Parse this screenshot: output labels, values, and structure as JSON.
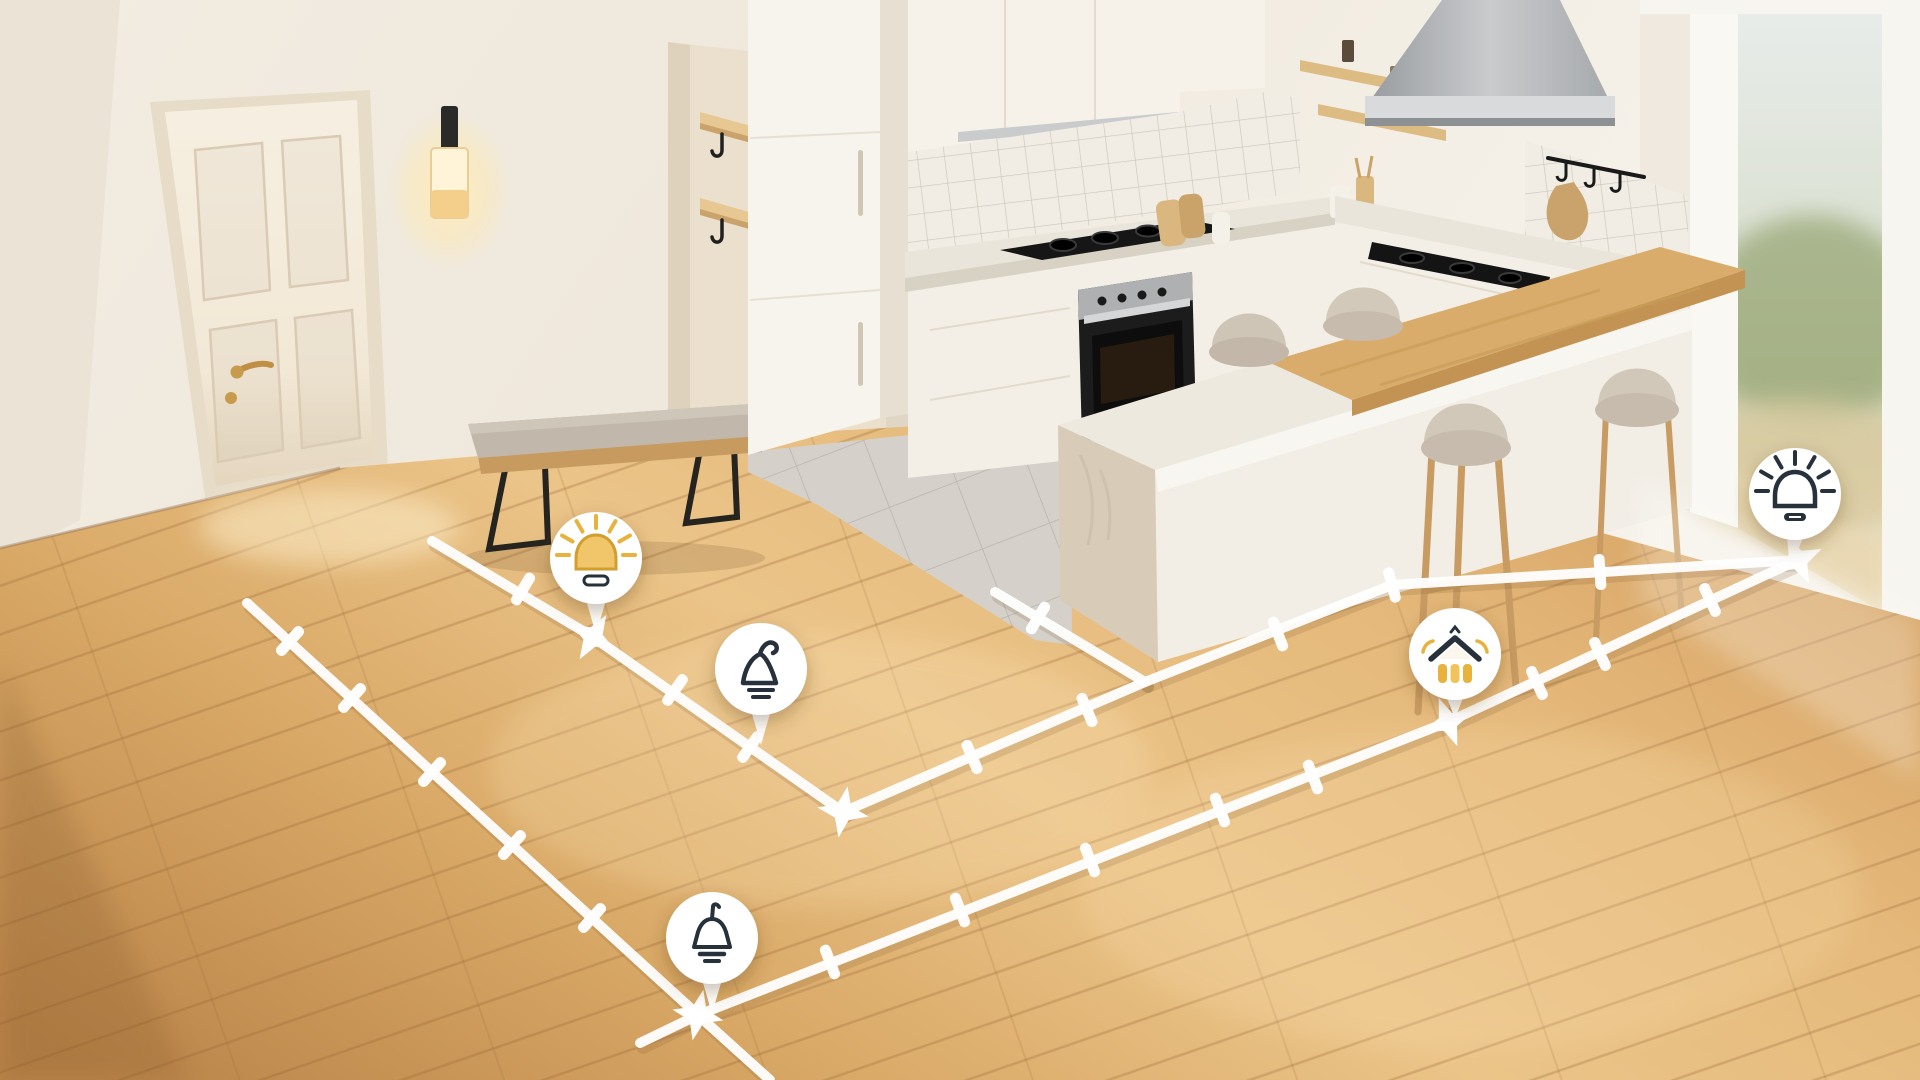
{
  "palette": {
    "path_white": "#FFFFFF",
    "icon_dark": "#26313C",
    "icon_yellow": "#E7B33C",
    "icon_yellow_fill": "#F1C66B",
    "icon_yellow_stroke": "#D29E2E",
    "balloon_fill": "#FFFFFF",
    "floor_light": "#ECC58A",
    "floor_dark": "#C08A4D"
  },
  "pins": [
    {
      "id": "dome-lamp-on",
      "icon": "dome-lamp-filled",
      "x": 596,
      "y": 558,
      "anchor_x": 593,
      "anchor_y": 637
    },
    {
      "id": "cone-lamp",
      "icon": "cone-lamp",
      "x": 761,
      "y": 669,
      "anchor_x": 750,
      "anchor_y": 747
    },
    {
      "id": "pendant-lamp",
      "icon": "pendant-lamp",
      "x": 712,
      "y": 938,
      "anchor_x": 700,
      "anchor_y": 1016
    },
    {
      "id": "home-light",
      "icon": "home-light",
      "x": 1455,
      "y": 654,
      "anchor_x": 1448,
      "anchor_y": 722
    },
    {
      "id": "dome-lamp-outline",
      "icon": "dome-lamp-outline",
      "x": 1795,
      "y": 494,
      "anchor_x": 1798,
      "anchor_y": 561
    }
  ],
  "path_network": {
    "stroke_width": 10,
    "lines": [
      {
        "name": "wall-side-line",
        "points": [
          [
            432,
            541
          ],
          [
            593,
            637
          ],
          [
            750,
            747
          ],
          [
            843,
            812
          ]
        ]
      },
      {
        "name": "island-front-line",
        "points": [
          [
            843,
            812
          ],
          [
            1145,
            682
          ]
        ]
      },
      {
        "name": "island-side-line",
        "points": [
          [
            1145,
            682
          ],
          [
            995,
            592
          ]
        ]
      },
      {
        "name": "bar-front-line",
        "points": [
          [
            1145,
            682
          ],
          [
            1392,
            585
          ],
          [
            1798,
            560
          ]
        ]
      },
      {
        "name": "outer-left-line",
        "points": [
          [
            247,
            603
          ],
          [
            698,
            1015
          ],
          [
            770,
            1080
          ]
        ]
      },
      {
        "name": "outer-bottom-line",
        "points": [
          [
            640,
            1043
          ],
          [
            698,
            1015
          ],
          [
            1448,
            722
          ],
          [
            1798,
            560
          ]
        ]
      }
    ],
    "nodes": [
      {
        "x": 523,
        "y": 589,
        "a": 31
      },
      {
        "x": 675,
        "y": 690,
        "a": 35
      },
      {
        "x": 750,
        "y": 747,
        "a": 35
      },
      {
        "x": 972,
        "y": 757,
        "a": -23
      },
      {
        "x": 1087,
        "y": 710,
        "a": -23
      },
      {
        "x": 1038,
        "y": 618,
        "a": 31
      },
      {
        "x": 1278,
        "y": 634,
        "a": -21
      },
      {
        "x": 1392,
        "y": 585,
        "a": -15
      },
      {
        "x": 1600,
        "y": 572,
        "a": -4
      },
      {
        "x": 290,
        "y": 641,
        "a": 42
      },
      {
        "x": 352,
        "y": 698,
        "a": 42
      },
      {
        "x": 432,
        "y": 772,
        "a": 42
      },
      {
        "x": 512,
        "y": 845,
        "a": 42
      },
      {
        "x": 592,
        "y": 918,
        "a": 42
      },
      {
        "x": 830,
        "y": 962,
        "a": -21
      },
      {
        "x": 960,
        "y": 910,
        "a": -21
      },
      {
        "x": 1090,
        "y": 860,
        "a": -21
      },
      {
        "x": 1220,
        "y": 810,
        "a": -21
      },
      {
        "x": 1313,
        "y": 777,
        "a": -21
      },
      {
        "x": 1537,
        "y": 683,
        "a": -25
      },
      {
        "x": 1600,
        "y": 654,
        "a": -25
      },
      {
        "x": 1710,
        "y": 600,
        "a": -25
      }
    ],
    "anchors": [
      {
        "x": 593,
        "y": 637,
        "a": 31
      },
      {
        "x": 843,
        "y": 812,
        "a": 10
      },
      {
        "x": 698,
        "y": 1015,
        "a": 12
      },
      {
        "x": 1448,
        "y": 722,
        "a": -21
      },
      {
        "x": 1798,
        "y": 560,
        "a": -25
      }
    ]
  }
}
